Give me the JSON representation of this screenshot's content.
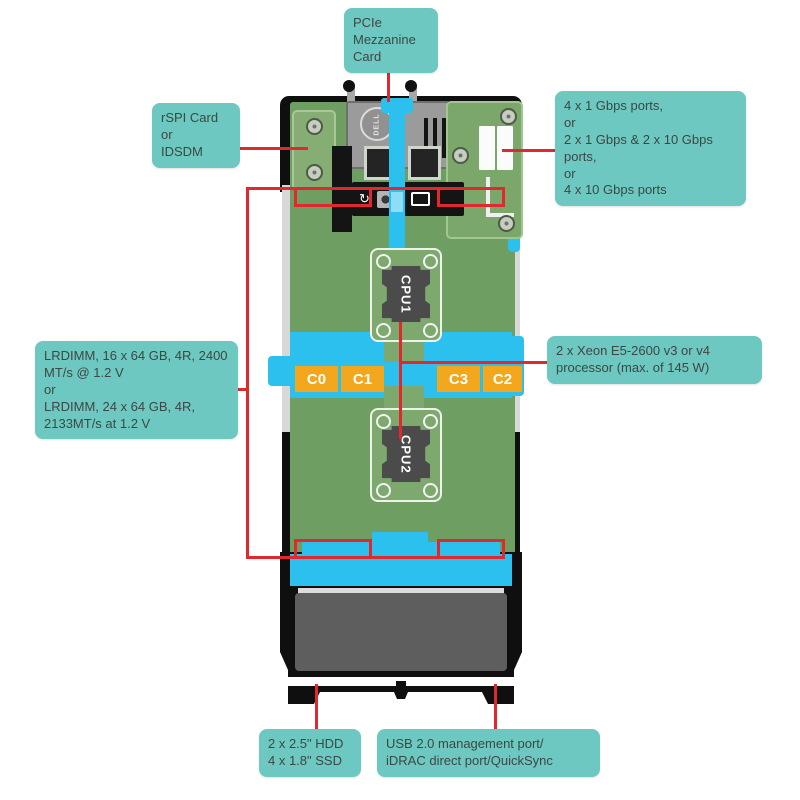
{
  "diagram": {
    "callouts": {
      "pcie": {
        "lines": [
          "PCIe",
          "Mezzanine",
          "Card"
        ]
      },
      "rspi": {
        "lines": [
          "rSPI Card",
          "or",
          "IDSDM"
        ]
      },
      "ports": {
        "lines": [
          "4 x 1 Gbps ports,",
          "or",
          "2 x 1 Gbps & 2 x 10 Gbps ports,",
          "or",
          "4 x 10 Gbps ports"
        ]
      },
      "lrdimm": {
        "lines": [
          "LRDIMM, 16 x 64 GB, 4R, 2400 MT/s @ 1.2 V",
          "or",
          "LRDIMM, 24 x 64 GB, 4R, 2133MT/s at 1.2 V"
        ]
      },
      "xeon": {
        "lines": [
          "2 x Xeon E5-2600 v3 or v4 processor (max. of 145 W)"
        ]
      },
      "hdd": {
        "lines": [
          "2 x 2.5\" HDD",
          "4 x 1.8\" SSD"
        ]
      },
      "usb": {
        "lines": [
          "USB 2.0 management port/",
          "iDRAC direct port/QuickSync"
        ]
      }
    },
    "server": {
      "brand": "DELL",
      "cpu1": "CPU1",
      "cpu2": "CPU2",
      "channel_labels": [
        "C0",
        "C1",
        "C3",
        "C2"
      ]
    },
    "memory": {
      "banks": 4,
      "slots_per_bank": 6
    },
    "colors": {
      "callout_bg": "#6cc8c0",
      "callout_text": "#3e4743",
      "annotation_red": "#e0292f",
      "pcb_green": "#6f9e63",
      "accent_cyan": "#2bc0ee",
      "channel_orange": "#f2a71d",
      "chassis_black": "#0f0f0f",
      "rail_gray": "#d8d8d8",
      "bay_gray": "#5e5e5e"
    }
  }
}
